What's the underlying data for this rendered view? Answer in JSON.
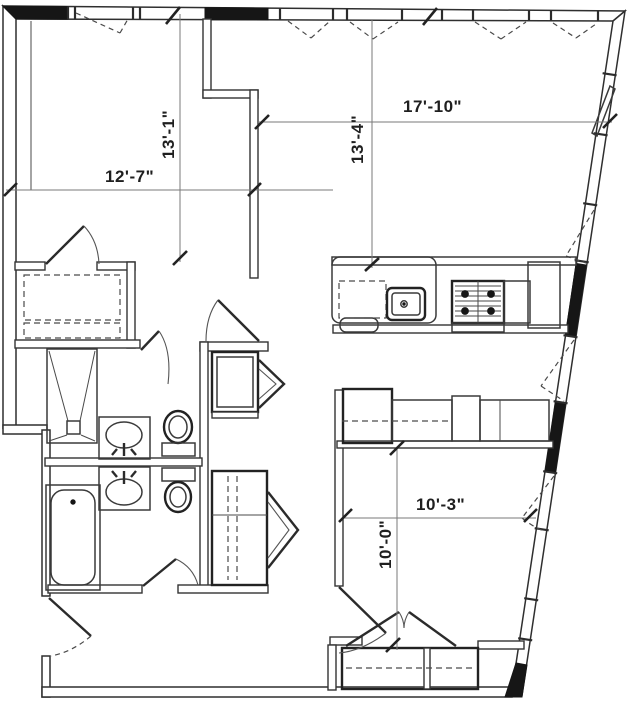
{
  "document": {
    "type": "apartment-floor-plan",
    "units": "feet-inches"
  },
  "colors": {
    "wall_line": "#2f2f2f",
    "solid_wall_fill": "#161616",
    "dimension_line": "#7a7a7a",
    "dimension_text": "#1f1f1f",
    "background": "#ffffff"
  },
  "dimensions": {
    "bedroom1_width": "12'-7\"",
    "bedroom1_depth": "13'-1\"",
    "living_width": "17'-10\"",
    "living_depth": "13'-4\"",
    "bedroom2_width": "10'-3\"",
    "bedroom2_depth": "10'-0\""
  }
}
